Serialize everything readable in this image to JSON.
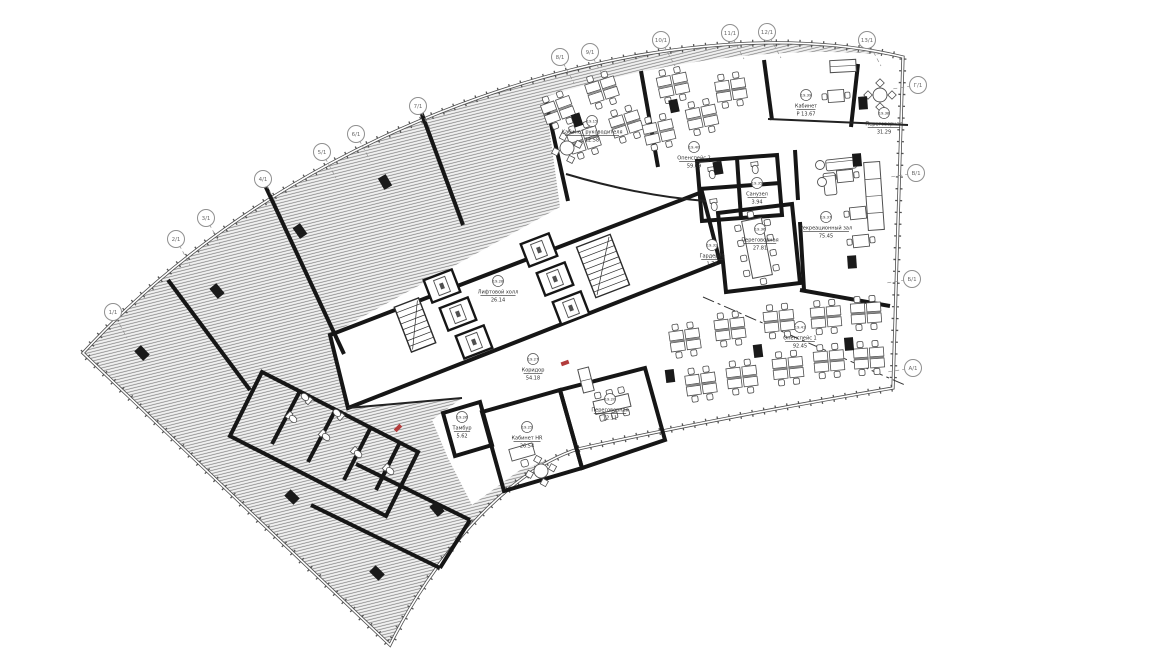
{
  "colors": {
    "wall": "#161616",
    "line": "#4a4a4a",
    "furn": "#4f4f4f",
    "hatch_line": "#7c7c7c",
    "hatch_bg": "#f1f1f1",
    "bubble": "#8f8f8f",
    "text": "#2e2e2e",
    "accent": "#b23b3b",
    "facade": "#4d4d4d"
  },
  "grid_bubbles": [
    {
      "label": "1/1",
      "x": 113,
      "y": 312,
      "side": "top"
    },
    {
      "label": "2/1",
      "x": 176,
      "y": 239,
      "side": "top"
    },
    {
      "label": "3/1",
      "x": 206,
      "y": 218,
      "side": "top"
    },
    {
      "label": "4/1",
      "x": 263,
      "y": 179,
      "side": "top"
    },
    {
      "label": "5/1",
      "x": 322,
      "y": 152,
      "side": "top"
    },
    {
      "label": "6/1",
      "x": 356,
      "y": 134,
      "side": "top"
    },
    {
      "label": "7/1",
      "x": 418,
      "y": 106,
      "side": "top"
    },
    {
      "label": "8/1",
      "x": 560,
      "y": 57,
      "side": "top"
    },
    {
      "label": "9/1",
      "x": 590,
      "y": 52,
      "side": "top"
    },
    {
      "label": "10/1",
      "x": 661,
      "y": 40,
      "side": "top"
    },
    {
      "label": "11/1",
      "x": 730,
      "y": 33,
      "side": "top"
    },
    {
      "label": "12/1",
      "x": 767,
      "y": 32,
      "side": "top"
    },
    {
      "label": "13/1",
      "x": 867,
      "y": 40,
      "side": "top"
    },
    {
      "label": "Г/1",
      "x": 918,
      "y": 85,
      "side": "right"
    },
    {
      "label": "В/1",
      "x": 916,
      "y": 173,
      "side": "right"
    },
    {
      "label": "Б/1",
      "x": 912,
      "y": 279,
      "side": "right"
    },
    {
      "label": "А/1",
      "x": 913,
      "y": 368,
      "side": "right"
    }
  ],
  "room_labels": [
    {
      "tag": "19.15",
      "name": "Кабинет руководителя",
      "area": "12.58",
      "x": 592,
      "y": 132
    },
    {
      "tag": "19.40",
      "name": "Опенспейс 2",
      "area": "59.69",
      "x": 694,
      "y": 158
    },
    {
      "tag": "19.39",
      "name": "Кабинет",
      "area": "Р 13.67",
      "x": 806,
      "y": 106
    },
    {
      "tag": "19.38",
      "name": "Переговорная",
      "area": "31.29",
      "x": 884,
      "y": 124
    },
    {
      "tag": "19.37",
      "name": "Рекреационный зал",
      "area": "75.45",
      "x": 826,
      "y": 228
    },
    {
      "tag": "19.36",
      "name": "Переговорная",
      "area": "27.81",
      "x": 760,
      "y": 240
    },
    {
      "tag": "19.35",
      "name": "Санузел",
      "area": "3.94",
      "x": 757,
      "y": 194
    },
    {
      "tag": "19.32",
      "name": "Гардероб",
      "area": "1.76",
      "x": 712,
      "y": 256
    },
    {
      "tag": "19.28",
      "name": "Лифтовой холл",
      "area": "26.14",
      "x": 498,
      "y": 292
    },
    {
      "tag": "19.27",
      "name": "Коридор",
      "area": "54.18",
      "x": 533,
      "y": 370
    },
    {
      "tag": "19.25",
      "name": "Кабинет HR",
      "area": "26.54",
      "x": 527,
      "y": 438
    },
    {
      "tag": "19.20",
      "name": "Переговорная",
      "area": "12.11",
      "x": 610,
      "y": 410
    },
    {
      "tag": "19.26",
      "name": "Тамбур",
      "area": "5.62",
      "x": 462,
      "y": 428
    },
    {
      "tag": "19.41",
      "name": "Опенспейс 1",
      "area": "92.45",
      "x": 800,
      "y": 338
    }
  ],
  "desk_clusters": [
    {
      "x": 558,
      "y": 110,
      "r": -20
    },
    {
      "x": 602,
      "y": 90,
      "r": -18
    },
    {
      "x": 584,
      "y": 140,
      "r": -18
    },
    {
      "x": 626,
      "y": 124,
      "r": -18
    },
    {
      "x": 673,
      "y": 85,
      "r": -12
    },
    {
      "x": 702,
      "y": 117,
      "r": -12
    },
    {
      "x": 731,
      "y": 90,
      "r": -9
    },
    {
      "x": 659,
      "y": 132,
      "r": -13
    },
    {
      "x": 685,
      "y": 340,
      "r": -8
    },
    {
      "x": 730,
      "y": 329,
      "r": -7
    },
    {
      "x": 779,
      "y": 321,
      "r": -6
    },
    {
      "x": 826,
      "y": 317,
      "r": -5
    },
    {
      "x": 866,
      "y": 313,
      "r": -4
    },
    {
      "x": 701,
      "y": 384,
      "r": -8
    },
    {
      "x": 742,
      "y": 377,
      "r": -7
    },
    {
      "x": 788,
      "y": 368,
      "r": -6
    },
    {
      "x": 829,
      "y": 361,
      "r": -5
    },
    {
      "x": 869,
      "y": 358,
      "r": -4
    }
  ],
  "desks": [
    {
      "x": 522,
      "y": 452,
      "r": -16
    }
  ],
  "round_tables": [
    {
      "x": 880,
      "y": 95,
      "r": 0
    },
    {
      "x": 567,
      "y": 148,
      "r": -18
    },
    {
      "x": 541,
      "y": 471,
      "r": -16
    }
  ],
  "meeting_tables": [
    {
      "x": 757,
      "y": 248,
      "w": 20,
      "h": 58,
      "r": -11,
      "cs": 4,
      "ce": 1
    },
    {
      "x": 612,
      "y": 404,
      "w": 36,
      "h": 13,
      "r": -13,
      "cs": 3,
      "ce": 0
    }
  ],
  "tables2": [
    {
      "x": 836,
      "y": 96,
      "r": -4
    },
    {
      "x": 858,
      "y": 213,
      "r": -6
    },
    {
      "x": 861,
      "y": 241,
      "r": -6
    },
    {
      "x": 845,
      "y": 176,
      "r": -6
    }
  ],
  "sofas": [
    {
      "x": 841,
      "y": 164,
      "w": 30,
      "h": 11,
      "r": -6
    },
    {
      "x": 830,
      "y": 184,
      "w": 12,
      "h": 22,
      "r": -6
    }
  ],
  "armchairs": [
    {
      "x": 820,
      "y": 165
    },
    {
      "x": 822,
      "y": 182
    }
  ],
  "counters": [
    {
      "x": 874,
      "y": 196,
      "w": 16,
      "h": 68,
      "r": -4,
      "div": 4
    },
    {
      "x": 843,
      "y": 66,
      "w": 26,
      "h": 12,
      "r": -3,
      "div": 2
    },
    {
      "x": 586,
      "y": 380,
      "w": 11,
      "h": 24,
      "r": -14,
      "div": 2
    }
  ],
  "toilets": [
    {
      "x": 292,
      "y": 418,
      "r": -47
    },
    {
      "x": 325,
      "y": 436,
      "r": -47
    },
    {
      "x": 357,
      "y": 453,
      "r": -47
    },
    {
      "x": 389,
      "y": 470,
      "r": -47
    },
    {
      "x": 306,
      "y": 398,
      "r": 133
    },
    {
      "x": 338,
      "y": 414,
      "r": 133
    },
    {
      "x": 712,
      "y": 173,
      "r": -8
    },
    {
      "x": 755,
      "y": 168,
      "r": -8
    },
    {
      "x": 714,
      "y": 205,
      "r": -8
    }
  ],
  "columns": [
    {
      "x": 577,
      "y": 120,
      "r": -18
    },
    {
      "x": 674,
      "y": 106,
      "r": -12
    },
    {
      "x": 863,
      "y": 103,
      "r": -4
    },
    {
      "x": 857,
      "y": 160,
      "r": -5
    },
    {
      "x": 852,
      "y": 262,
      "r": -4
    },
    {
      "x": 670,
      "y": 376,
      "r": -7
    },
    {
      "x": 758,
      "y": 351,
      "r": -7
    },
    {
      "x": 849,
      "y": 344,
      "r": -5
    },
    {
      "x": 385,
      "y": 182,
      "r": -30
    },
    {
      "x": 300,
      "y": 231,
      "r": -35
    },
    {
      "x": 217,
      "y": 291,
      "r": -40
    },
    {
      "x": 142,
      "y": 353,
      "r": -43
    },
    {
      "x": 292,
      "y": 497,
      "r": -45
    },
    {
      "x": 377,
      "y": 573,
      "r": -45
    },
    {
      "x": 437,
      "y": 509,
      "r": -40
    },
    {
      "x": 718,
      "y": 168,
      "r": -10
    }
  ],
  "stairs": [
    {
      "x": 415,
      "y": 325,
      "w": 26,
      "h": 48,
      "r": -21
    },
    {
      "x": 603,
      "y": 266,
      "w": 36,
      "h": 54,
      "r": -21
    }
  ],
  "elevators": [
    {
      "x": 442,
      "y": 286,
      "r": -21
    },
    {
      "x": 458,
      "y": 314,
      "r": -21
    },
    {
      "x": 474,
      "y": 342,
      "r": -21
    },
    {
      "x": 539,
      "y": 250,
      "r": -21
    },
    {
      "x": 555,
      "y": 279,
      "r": -21
    },
    {
      "x": 571,
      "y": 308,
      "r": -21
    }
  ],
  "red_marks": [
    {
      "x": 565,
      "y": 363,
      "r": -20
    },
    {
      "x": 398,
      "y": 428,
      "r": -45
    }
  ]
}
